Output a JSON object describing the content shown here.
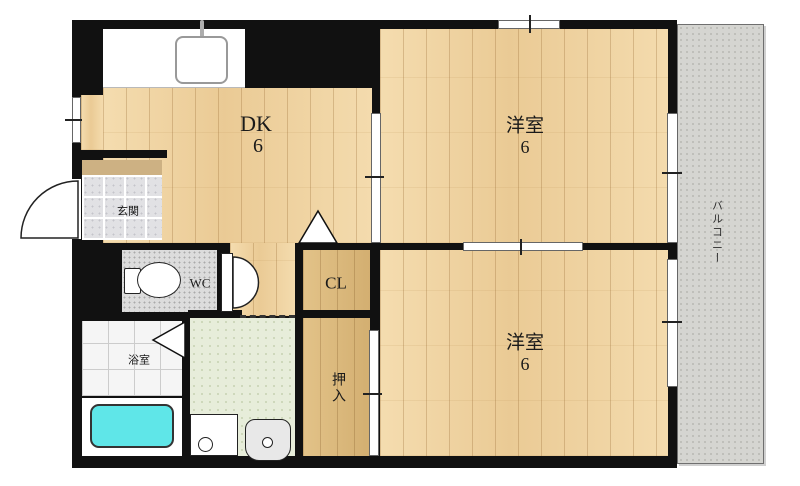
{
  "floorplan": {
    "rooms": {
      "dk": {
        "label": "DK",
        "size": "6"
      },
      "western_upper": {
        "label": "洋室",
        "size": "6"
      },
      "western_lower": {
        "label": "洋室",
        "size": "6"
      },
      "closet": {
        "label": "CL"
      },
      "oshiire": {
        "label": "押入"
      },
      "entrance": {
        "label": "玄関"
      },
      "bathroom": {
        "label": "浴室"
      },
      "toilet": {
        "label": "WC"
      },
      "balcony": {
        "label": "バルコニー"
      }
    },
    "colors": {
      "wall": "#111111",
      "wood_floor": "#efd3a2",
      "closet_floor": "#d9b77a",
      "entrance_tile": "#e1e1e4",
      "entrance_step": "#cdb183",
      "bath_tile": "#f5f5f5",
      "washroom_floor": "#e7edda",
      "wc_floor": "#dcdcdc",
      "balcony_floor": "#d5d5d1",
      "bathtub": "#5fe6e8"
    }
  }
}
